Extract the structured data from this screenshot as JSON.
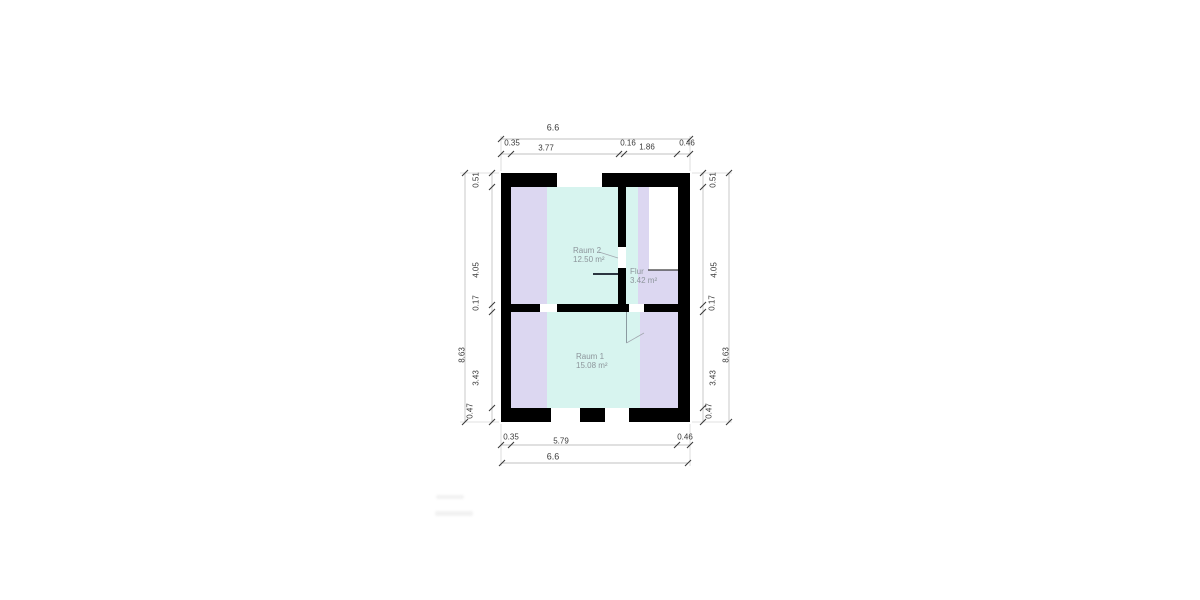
{
  "rooms": [
    {
      "name": "Raum 2",
      "area": "12.50 m²"
    },
    {
      "name": "Flur",
      "area": "3.42 m²"
    },
    {
      "name": "Raum 1",
      "area": "15.08 m²"
    }
  ],
  "dimensions": {
    "top": {
      "overall": "6.6",
      "segments": [
        "0.35",
        "3.77",
        "0.16",
        "1.86",
        "0.46"
      ]
    },
    "bottom": {
      "overall": "6.6",
      "segments": [
        "0.35",
        "5.79",
        "0.46"
      ]
    },
    "left": {
      "overall": "8.63",
      "segments": [
        "0.51",
        "4.05",
        "0.17",
        "3.43",
        "0.47"
      ]
    },
    "right": {
      "overall": "8.63",
      "segments": [
        "0.51",
        "4.05",
        "0.17",
        "3.43",
        "0.47"
      ]
    }
  },
  "colors": {
    "wall": "#000000",
    "fill-cyan": "#d7f4ef",
    "fill-lavender": "#dcd7f1",
    "room-label": "#8d959b",
    "dim-text": "#3a3a3a",
    "dim-line": "#c2c2c2",
    "tick": "#3a3a3a",
    "door-dark": "#2b3540",
    "stair-line": "#3a3a3a"
  }
}
